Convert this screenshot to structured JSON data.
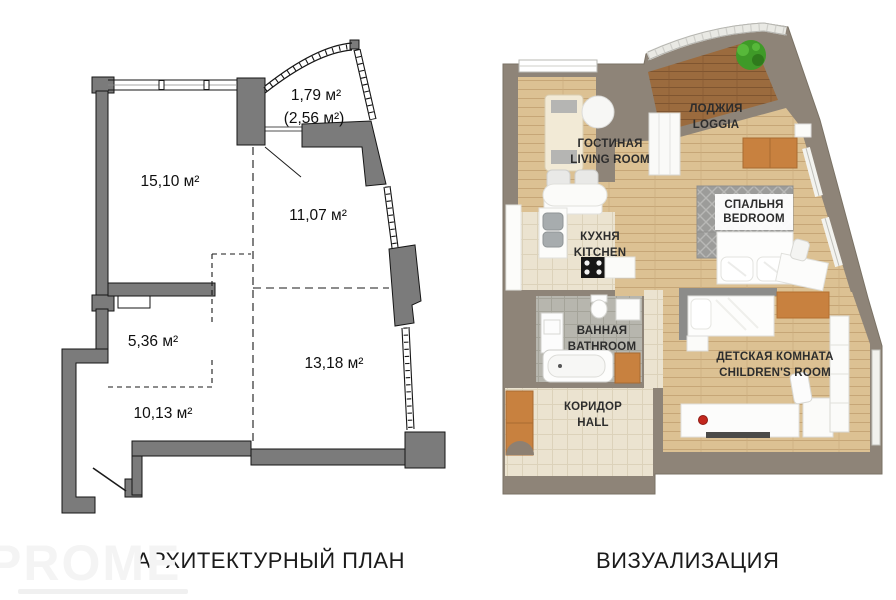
{
  "architectural_plan": {
    "caption": "АРХИТЕКТУРНЫЙ ПЛАН",
    "areas": {
      "loggia": "1,79 м²",
      "loggia_total": "(2,56 м²)",
      "living_room": "15,10 м²",
      "bedroom": "11,07 м²",
      "kitchen": "5,36 м²",
      "children_room": "13,18 м²",
      "hall": "10,13 м²"
    }
  },
  "visualization": {
    "caption": "ВИЗУАЛИЗАЦИЯ",
    "rooms": {
      "loggia": {
        "ru": "ЛОДЖИЯ",
        "en": "LOGGIA"
      },
      "living_room": {
        "ru": "ГОСТИНАЯ",
        "en": "LIVING ROOM"
      },
      "bedroom": {
        "ru": "СПАЛЬНЯ",
        "en": "BEDROOM"
      },
      "kitchen": {
        "ru": "КУХНЯ",
        "en": "KITCHEN"
      },
      "bathroom": {
        "ru": "ВАННАЯ",
        "en": "BATHROOM"
      },
      "children_room": {
        "ru": "ДЕТСКАЯ КОМНАТА",
        "en": "CHILDREN'S ROOM"
      },
      "hall": {
        "ru": "КОРИДОР",
        "en": "HALL"
      }
    }
  },
  "watermark": {
    "text": "PROME"
  },
  "colors": {
    "plan_wall": "#7b7b7b",
    "viz_wall": "#8e8478",
    "wood": "#dcc193",
    "wood_dark": "#9b6b3e",
    "tile": "#ebe3d0",
    "tile_gray": "#b7b6ae",
    "cabinet_orange": "#c8813f",
    "plant_green": "#3f9a28",
    "accent_red": "#c3271d"
  }
}
